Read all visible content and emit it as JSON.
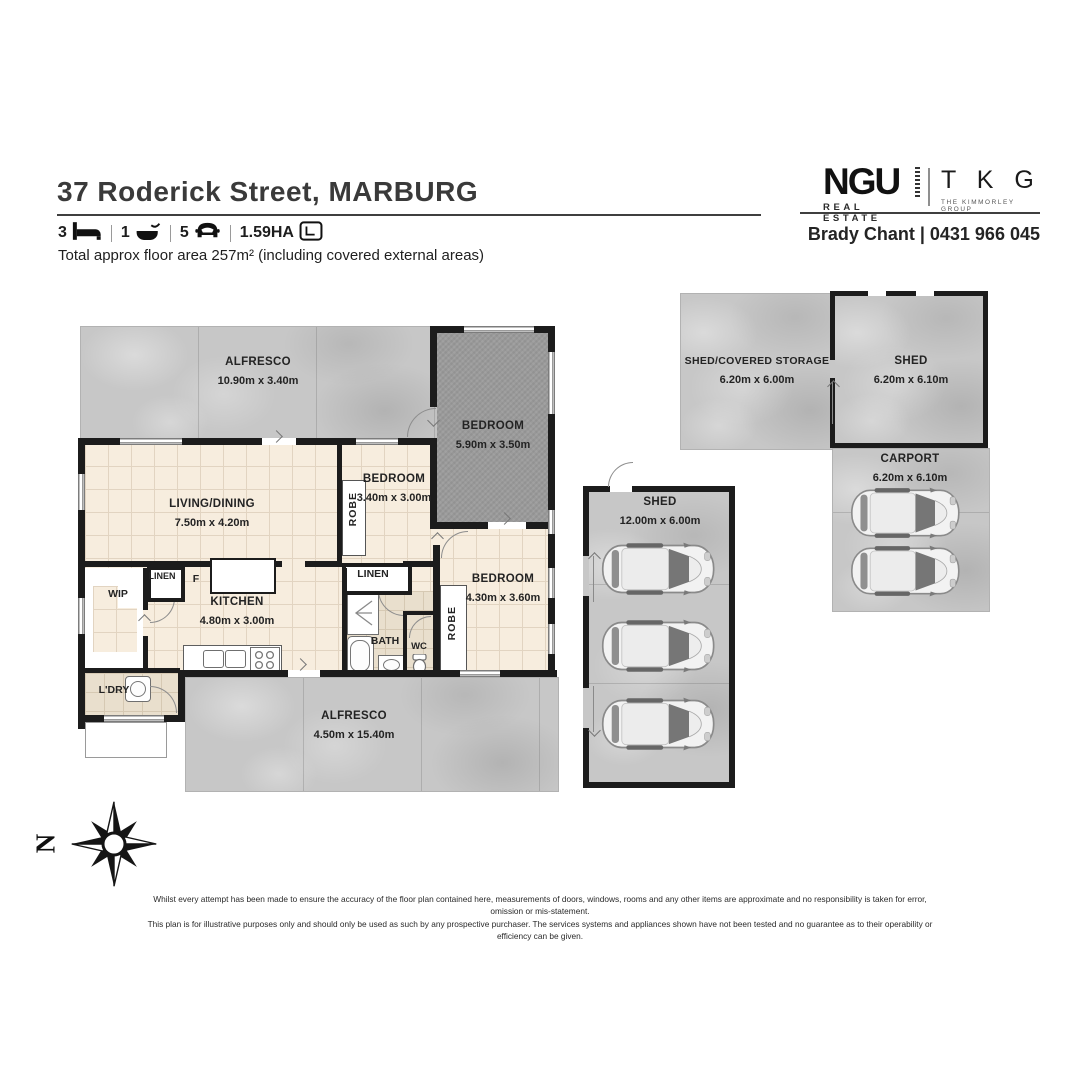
{
  "header": {
    "title": "37 Roderick Street, MARBURG",
    "beds": "3",
    "baths": "1",
    "cars": "5",
    "land_area": "1.59HA",
    "floor_area_note": "Total approx floor area 257m² (including covered external areas)"
  },
  "branding": {
    "ngu": "NGU",
    "ngu_sub": "REAL ESTATE",
    "tkg": "T K G",
    "tkg_sub": "THE KIMMORLEY GROUP",
    "agent_line": "Brady Chant | 0431 966 045"
  },
  "plan": {
    "alfresco_top": {
      "name": "ALFRESCO",
      "dims": "10.90m x 3.40m"
    },
    "bedroom_main": {
      "name": "BEDROOM",
      "dims": "5.90m x 3.50m"
    },
    "living": {
      "name": "LIVING/DINING",
      "dims": "7.50m x 4.20m"
    },
    "bedroom_2": {
      "name": "BEDROOM",
      "dims": "3.40m x 3.00m"
    },
    "kitchen": {
      "name": "KITCHEN",
      "dims": "4.80m x 3.00m"
    },
    "bedroom_3": {
      "name": "BEDROOM",
      "dims": "4.30m x 3.60m"
    },
    "alfresco_bottom": {
      "name": "ALFRESCO",
      "dims": "4.50m x 15.40m"
    },
    "wip": "WIP",
    "linen_1": "LINEN",
    "fridge": "F",
    "laundry": "L'DRY",
    "linen_2": "LINEN",
    "bath": "BATH",
    "wc": "WC",
    "robe_1": "ROBE",
    "robe_2": "ROBE"
  },
  "outbuildings": {
    "shed_storage": {
      "name": "SHED/COVERED STORAGE",
      "dims": "6.20m x 6.00m"
    },
    "shed_ne": {
      "name": "SHED",
      "dims": "6.20m x 6.10m"
    },
    "carport": {
      "name": "CARPORT",
      "dims": "6.20m x 6.10m"
    },
    "shed_w": {
      "name": "SHED",
      "dims": "12.00m x 6.00m"
    }
  },
  "compass": {
    "north": "N"
  },
  "disclaimer": {
    "line1": "Whilst every attempt has been made to ensure the accuracy of the floor plan contained here, measurements of doors, windows, rooms and any other items are approximate and no responsibility is taken for error, omission or mis-statement.",
    "line2": "This plan is for illustrative purposes only and should only be used as such by any prospective purchaser. The services systems and appliances shown have not been tested and no guarantee as to their operability or efficiency can be given."
  },
  "colors": {
    "wall": "#1c1c1c",
    "tile": "#f7edde",
    "concrete": "#c7c7c7",
    "carpet": "#9b9b9b"
  }
}
